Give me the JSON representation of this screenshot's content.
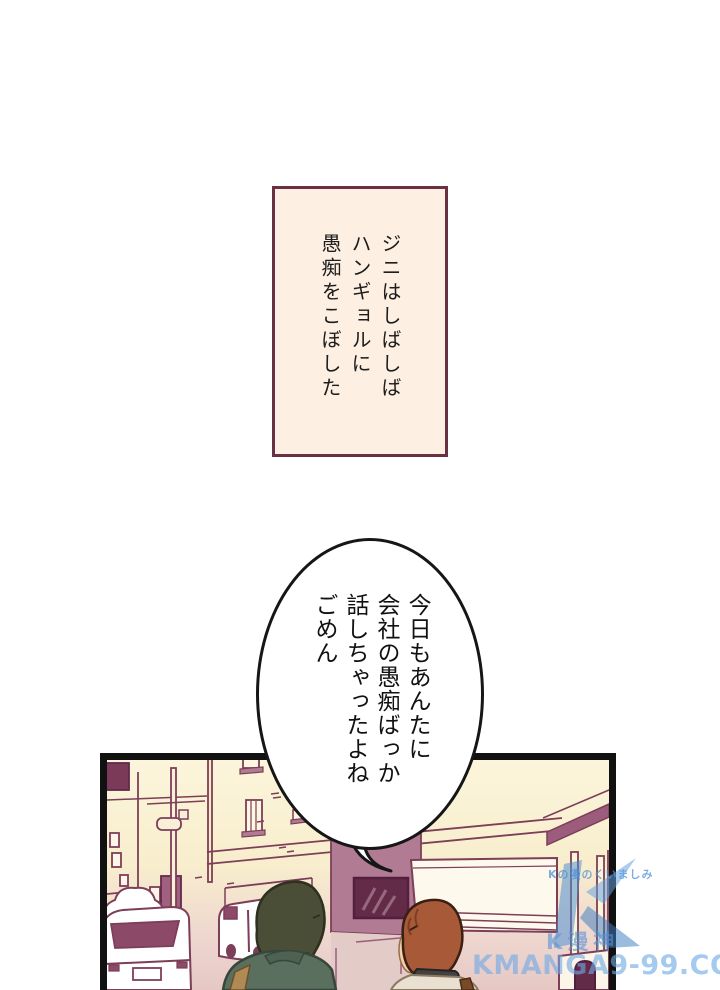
{
  "page": {
    "background": "#ffffff"
  },
  "narration_box": {
    "lines": [
      "ジニはしばしば",
      "ハンギョルに",
      "愚痴をこぼした"
    ],
    "fill_color": "#fdf0e3",
    "border_color": "#6a3044"
  },
  "speech_bubble": {
    "lines": [
      "今日もあんたに",
      "会社の愚痴ばっか",
      "話しちゃったよね",
      "ごめん"
    ],
    "fill_color": "#ffffff",
    "stroke_color": "#161616"
  },
  "panel": {
    "description": "Street scene: cream buildings with maroon outlines, storefronts, utility pole, parked white cars, and two characters seen from behind (olive-haired in green jacket, orange-haired in beige top with dark collar)",
    "palette": {
      "outline_maroon": "#7d3e58",
      "cream": "#f8eecd",
      "pink_street": "#e5c8c4",
      "dark_maroon": "#642b49",
      "wall_mauve": "#b17b93",
      "char1_hair": "#4b4e37",
      "char1_jacket": "#5b6f5e",
      "char2_hair": "#a85a38",
      "skin": "#f2d0ae"
    }
  },
  "watermark": {
    "small_text": "Kの漫のくいましみ",
    "logo_text": "K漫神",
    "site_text": "KMANGA9-99.COM",
    "color": "#4a8fd4"
  }
}
